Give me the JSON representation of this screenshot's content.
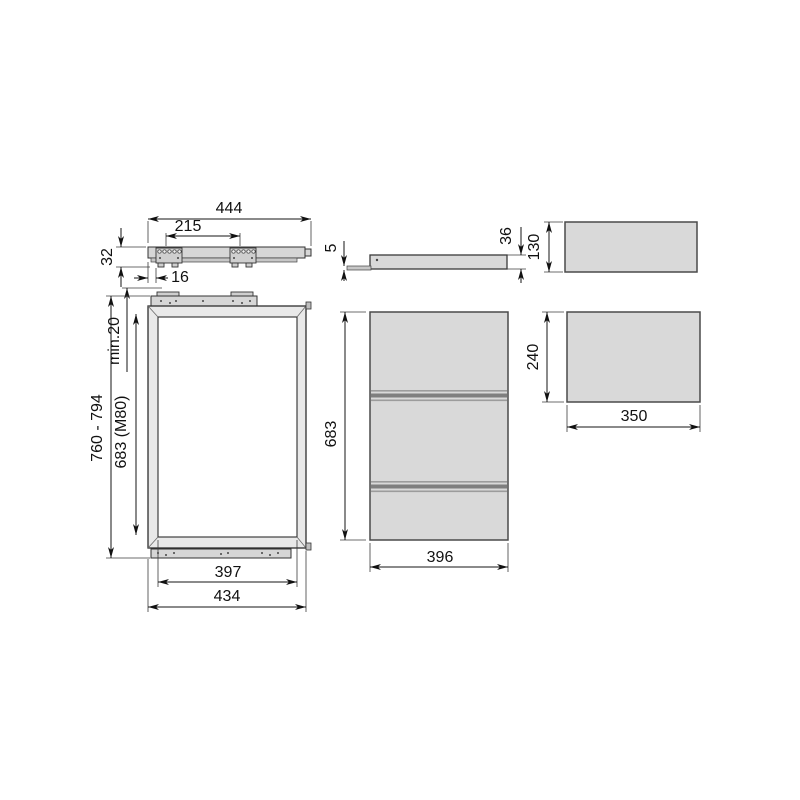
{
  "drawing": {
    "rail_top_view": {
      "total_length": "444",
      "bracket_spacing": "215",
      "rail_height": "32",
      "end_offset": "16"
    },
    "frame_front_view": {
      "top_clearance": "min.20",
      "mount_height_range": "760 - 794",
      "frame_height_model": "683 (M80)",
      "inner_width": "397",
      "outer_width": "434"
    },
    "rail_side_view": {
      "plate_thickness": "5",
      "profile_height": "36"
    },
    "panel_side_view": {
      "height": "683",
      "depth": "396"
    },
    "top_panel": {
      "height": "130"
    },
    "front_panel": {
      "height": "240",
      "width": "350"
    },
    "colors": {
      "panel_fill": "#d9d9d9",
      "frame_fill": "#e9e9e9",
      "line": "#161616"
    }
  }
}
